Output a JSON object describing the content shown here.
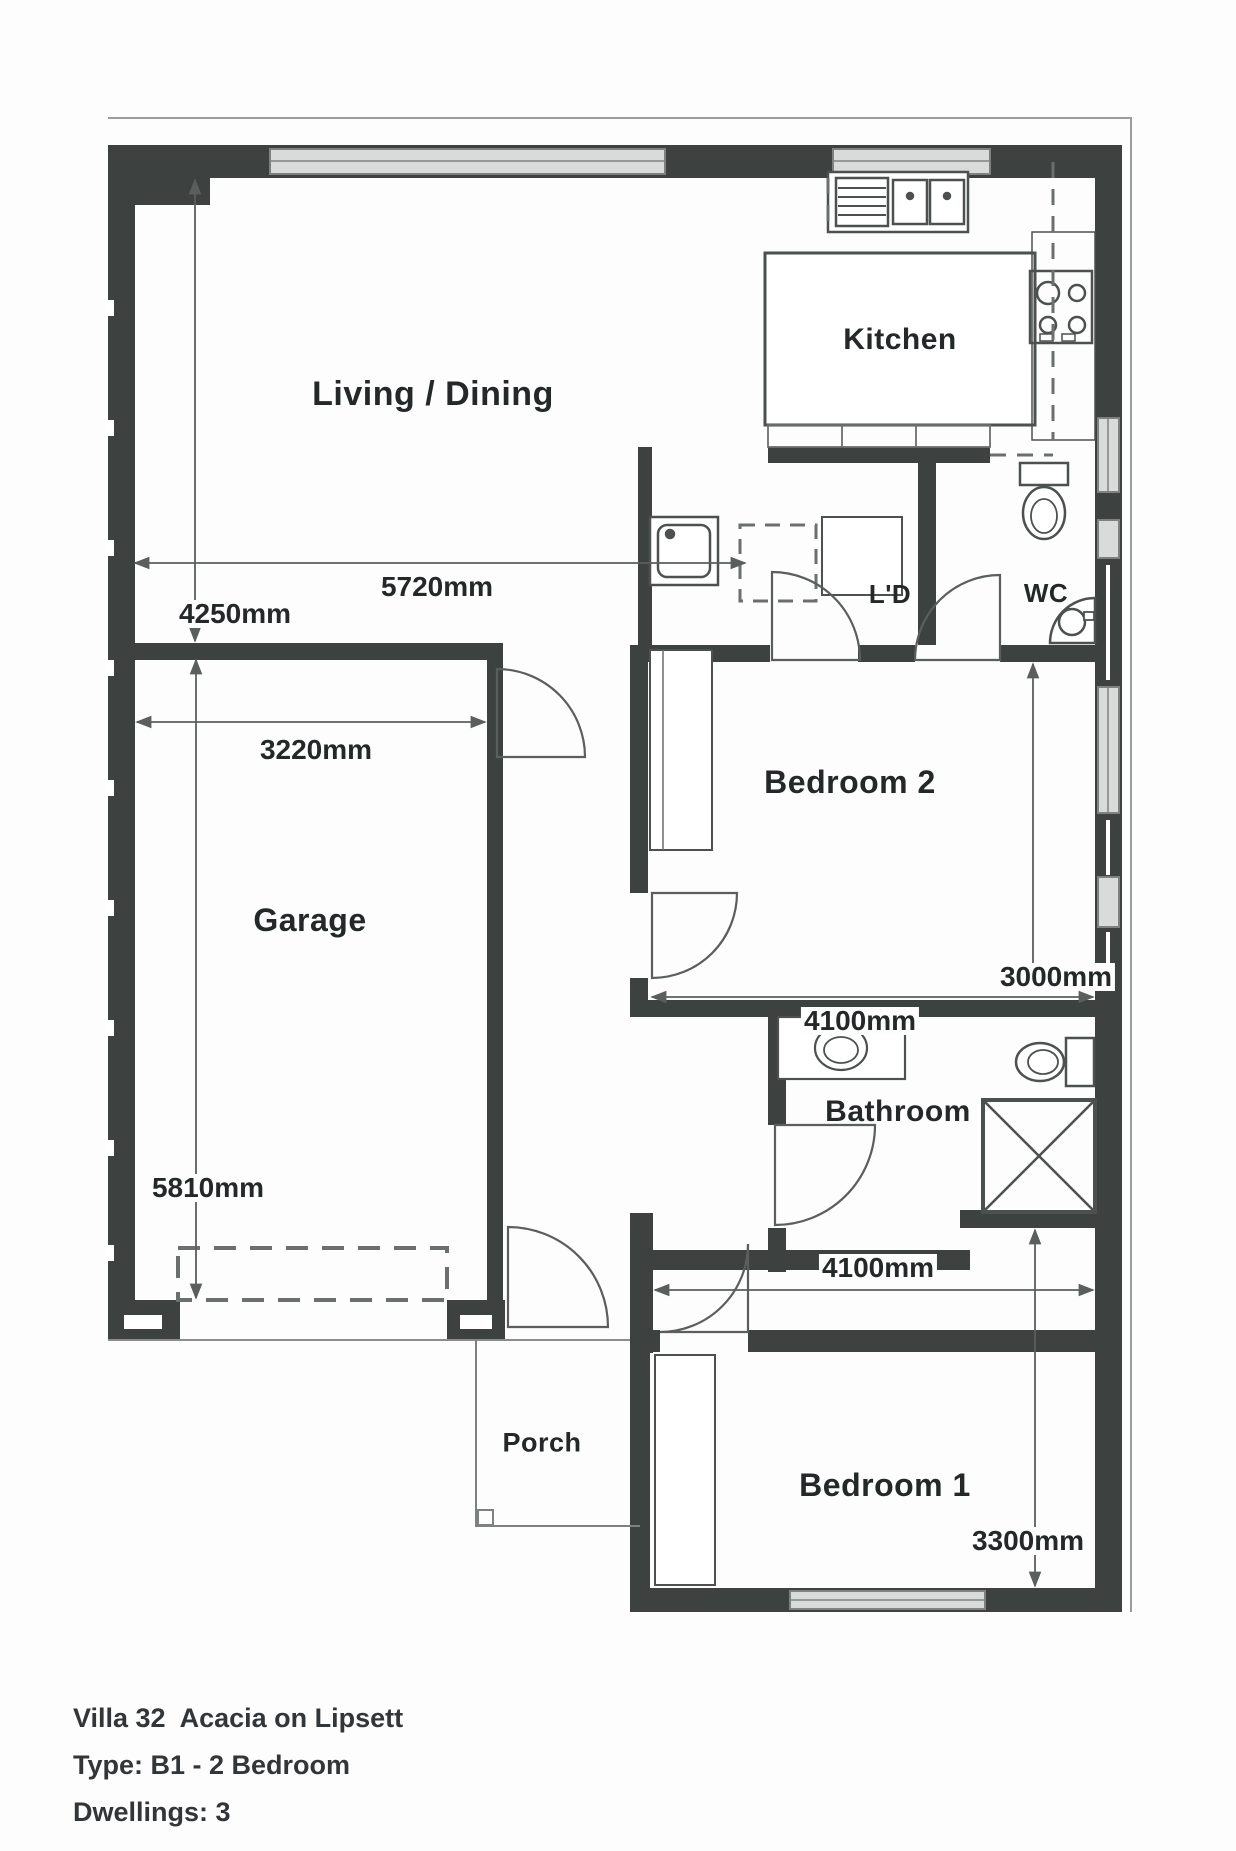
{
  "plan": {
    "rooms": {
      "living": "Living / Dining",
      "kitchen": "Kitchen",
      "laundry": "L'D",
      "wc": "WC",
      "bedroom2": "Bedroom 2",
      "garage": "Garage",
      "bathroom": "Bathroom",
      "bedroom1": "Bedroom 1",
      "porch": "Porch"
    },
    "dimensions": {
      "living_width": "5720mm",
      "living_depth": "4250mm",
      "garage_width": "3220mm",
      "garage_depth": "5810mm",
      "bedroom2_depth": "3000mm",
      "bedroom2_width": "4100mm",
      "hall_width": "4100mm",
      "bedroom1_depth": "3300mm"
    }
  },
  "footer": {
    "line1": "Villa 32  Acacia on Lipsett",
    "line2": "Type: B1 - 2 Bedroom",
    "line3": "Dwellings: 3"
  },
  "colors": {
    "wall": "#3d4241",
    "fixture_line": "#4c504f",
    "window_fill": "#d9dbda",
    "text": "#242829"
  }
}
